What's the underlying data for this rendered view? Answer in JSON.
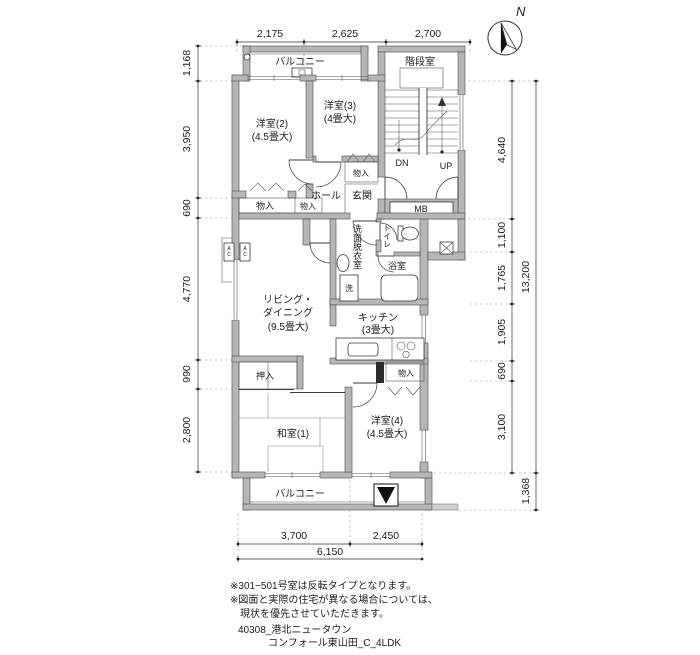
{
  "compass": {
    "north": "N"
  },
  "dims": {
    "top": [
      "2,175",
      "2,625",
      "2,700"
    ],
    "left": [
      "1,168",
      "3,950",
      "690",
      "4,770",
      "990",
      "2,800"
    ],
    "right": [
      "4,640",
      "1,100",
      "1,765",
      "1,905",
      "690",
      "3,100"
    ],
    "right_total": [
      "13,200",
      "1,368"
    ],
    "bottom": [
      "3,700",
      "2,450",
      "6,150"
    ]
  },
  "rooms": {
    "balcony_top": "バルコニー",
    "stairwell": "階段室",
    "bedroom2": {
      "name": "洋室(2)",
      "size": "(4.5畳大)"
    },
    "bedroom3": {
      "name": "洋室(3)",
      "size": "(4畳大)"
    },
    "closet_hall": "物入",
    "closet_b2_large": "物入",
    "closet_b2_small": "物入",
    "hall": "ホール",
    "entrance": "玄関",
    "mb": "MB",
    "dn": "DN",
    "up": "UP",
    "washroom": "洗面脱衣室",
    "toilet": "トイレ",
    "bath": "浴室",
    "washer": "洗",
    "kitchen": {
      "name": "キッチン",
      "size": "(3畳大)"
    },
    "living": {
      "line1": "リビング・",
      "line2": "ダイニング",
      "size": "(9.5畳大)"
    },
    "oshiire": "押入",
    "closet_b4": "物入",
    "washitsu": "和室(1)",
    "bedroom4": {
      "name": "洋室(4)",
      "size": "(4.5畳大)"
    },
    "balcony_bottom": "バルコニー",
    "ac": "AC"
  },
  "notes": [
    "※301~501号室は反転タイプとなります。",
    "※図面と実際の住宅が異なる場合については、",
    "現状を優先させていただきます。"
  ],
  "footer": [
    "40308_港北ニュータウン",
    "コンフォール東山田_C_4LDK"
  ]
}
